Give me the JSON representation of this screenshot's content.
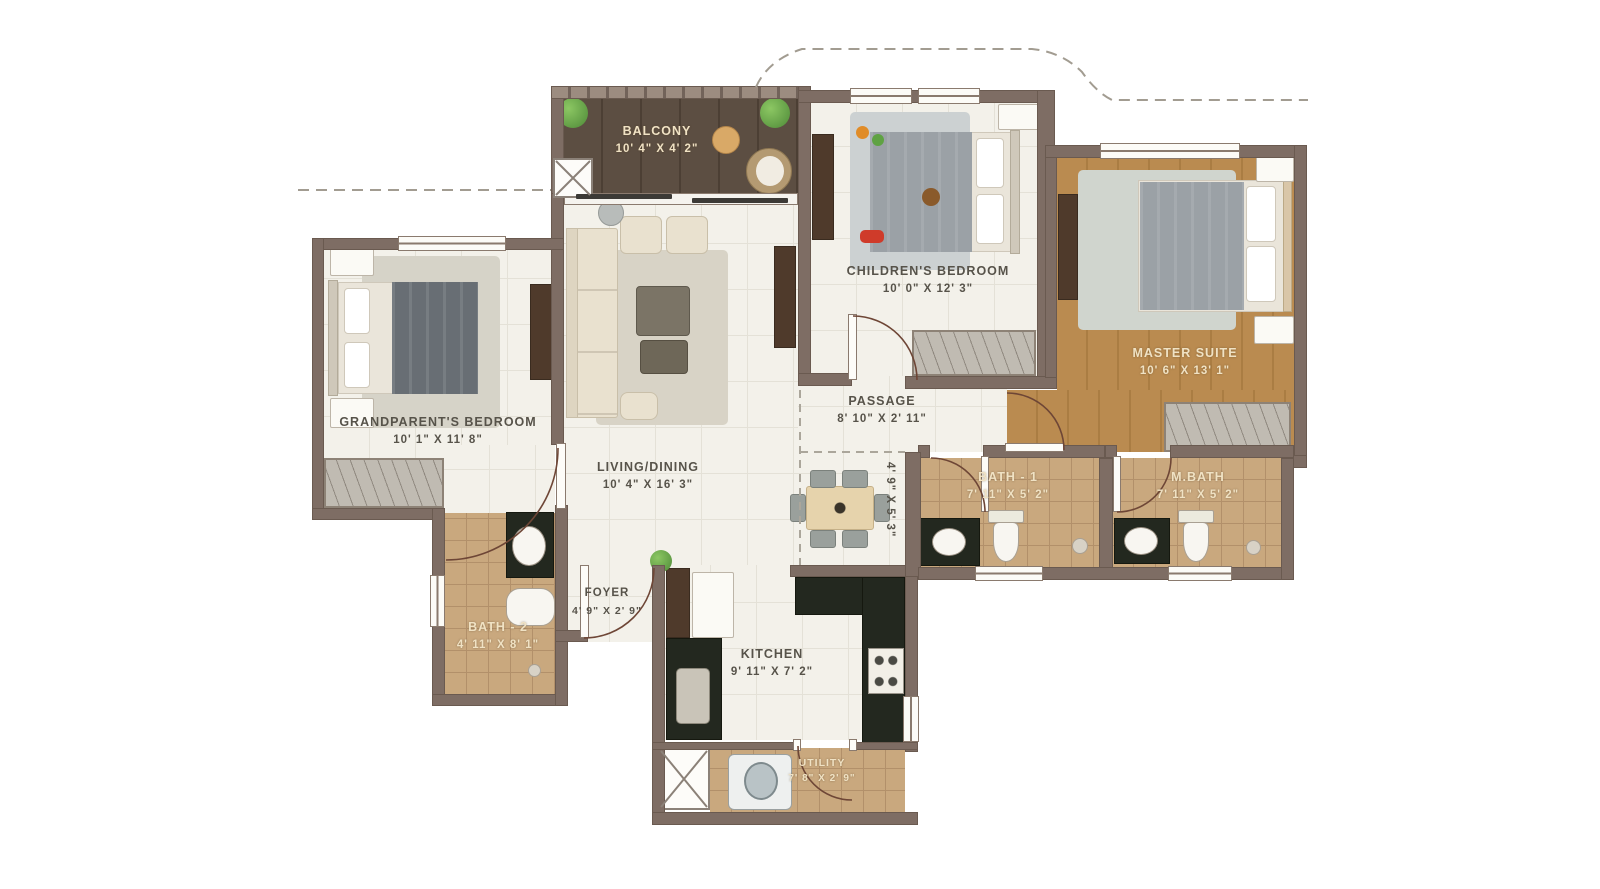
{
  "plan": {
    "type": "apartment-floor-plan",
    "colors": {
      "background": "#ffffff",
      "wall": "#7e6d64",
      "light_floor": "#f3f1ea",
      "bath_tile": "#c9a87e",
      "balcony_wood": "#5c4e42",
      "master_wood": "#ba8b50",
      "counter_dark": "#23281f",
      "label_dark": "#57534a",
      "label_cream": "#f0e2c4",
      "plant_green": "#68a84e",
      "door_arc": "#6e4636"
    },
    "rooms": {
      "balcony": {
        "name": "BALCONY",
        "dims": "10' 4\" X 4' 2\""
      },
      "living_dining": {
        "name": "LIVING/DINING",
        "dims": "10' 4\" X 16' 3\""
      },
      "grandparents_bedroom": {
        "name": "GRANDPARENT'S BEDROOM",
        "dims": "10' 1\" X 11' 8\""
      },
      "childrens_bedroom": {
        "name": "CHILDREN'S BEDROOM",
        "dims": "10' 0\" X 12' 3\""
      },
      "master_suite": {
        "name": "MASTER SUITE",
        "dims": "10' 6\" X 13' 1\""
      },
      "passage": {
        "name": "PASSAGE",
        "dims": "8' 10\" X 2' 11\""
      },
      "dining_nook": {
        "dims": "4' 9\" X 5' 3\""
      },
      "bath_1": {
        "name": "BATH - 1",
        "dims": "7' 11\" X 5' 2\""
      },
      "m_bath": {
        "name": "M.BATH",
        "dims": "7' 11\" X 5' 2\""
      },
      "bath_2": {
        "name": "BATH - 2",
        "dims": "4' 11\" X 8' 1\""
      },
      "foyer": {
        "name": "FOYER",
        "dims": "4' 9\" X 2' 9\""
      },
      "kitchen": {
        "name": "KITCHEN",
        "dims": "9' 11\" X 7' 2\""
      },
      "utility": {
        "name": "UTILITY",
        "dims": "7' 8\" X 2' 9\""
      }
    }
  }
}
